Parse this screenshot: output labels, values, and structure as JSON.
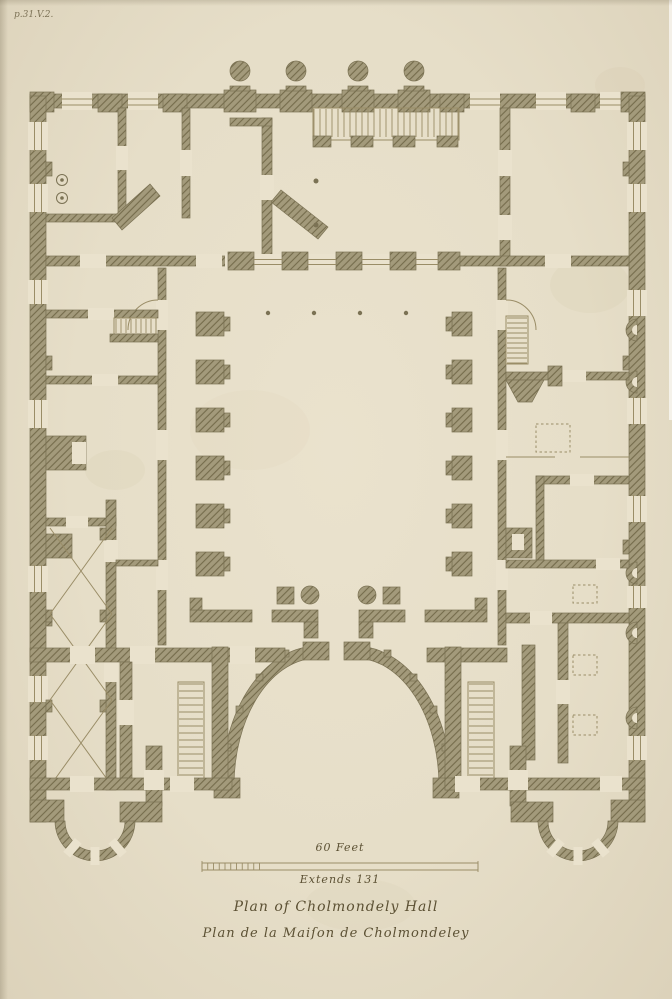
{
  "annotations": {
    "plate_ref": "p.31.V.2.",
    "scale_label": "60 Feet",
    "extent_label": "Extends 131",
    "title_primary": "Plan of Cholmondely Hall",
    "title_secondary": "Plan de la Maiſon de Cholmondeley"
  },
  "palette": {
    "paper": "#eae2cd",
    "paper_dark": "#dcd2ba",
    "wall_base": "#a39a7b",
    "wall_hatch": "#756c4c",
    "wall_edge": "#7b7254",
    "thin_line": "#9a8d67",
    "ink": "#5c5134"
  },
  "figure": {
    "features": [
      "central-courtyard",
      "north-portico-four-columns",
      "grand-staircase",
      "quadrant-screen-walls",
      "semicircular-corner-bows",
      "vaulted-gallery-cross-lines",
      "scale-bar"
    ]
  }
}
